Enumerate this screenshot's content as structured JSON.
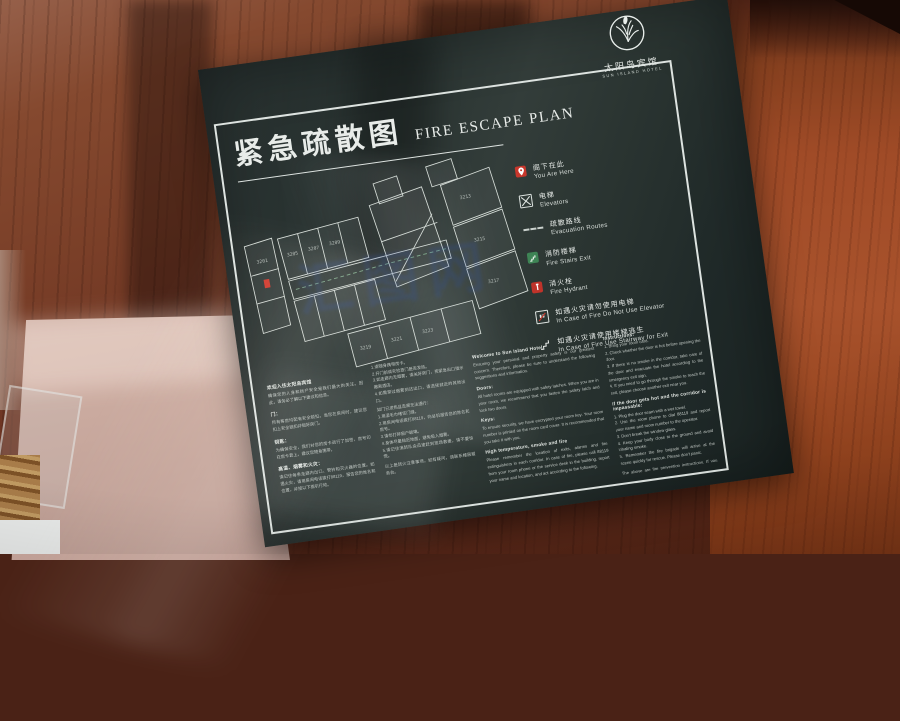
{
  "colors": {
    "sign_background": "#27312f",
    "accent_red": "#c8372c",
    "stairs_green": "#3e8455",
    "wood_brown": "#8a4127",
    "sign_text": "#e8ece9"
  },
  "watermark": {
    "text": "汇图网"
  },
  "sign": {
    "logo": {
      "zh": "太阳岛宾馆",
      "en": "SUN ISLAND HOTEL"
    },
    "title": {
      "zh": "紧急疏散图",
      "en": "FIRE ESCAPE PLAN"
    },
    "legend": [
      {
        "icon": "you-are-here-pin",
        "zh": "阁下在此",
        "en": "You Are Here"
      },
      {
        "icon": "elevator",
        "zh": "电梯",
        "en": "Elevators"
      },
      {
        "icon": "dashed-route",
        "zh": "疏散路线",
        "en": "Evacuation Routes"
      },
      {
        "icon": "green-stairs",
        "zh": "消防楼梯",
        "en": "Fire Stairs Exit"
      },
      {
        "icon": "red-hydrant",
        "zh": "消火栓",
        "en": "Fire Hydrant"
      },
      {
        "icon": "no-elevator",
        "zh": "如遇火灾请勿使用电梯",
        "en": "In Case of Fire Do Not Use Elevator"
      },
      {
        "icon": "stairway-exit",
        "zh": "如遇火灾请使用楼梯逃生",
        "en": "In Case of Fire Use Stairway for Exit"
      }
    ],
    "floor_plan": {
      "rooms": [
        "3201",
        "3205",
        "3207",
        "3209",
        "3213",
        "3215",
        "3217",
        "3219",
        "3221",
        "3223"
      ]
    },
    "info": {
      "zh_welcome": {
        "h0": "欢迎入住太阳岛宾馆",
        "p0": "确保您的人身和财产安全是我们最大的关注。因此，请务必了解以下建议和信息。",
        "h1": "门：",
        "p1": "所有客房均配有安全锁扣。当您在房间时，建议您扣上安全锁扣并锁好房门。",
        "h2": "钥匙：",
        "p2": "为确保安全，我们对您的房卡进行了加密，房号印在房卡套上，建议您随身携带。",
        "h3": "高温、烟雾和火灾：",
        "p3": "请记住每条走廊内出口、警铃和灭火器的位置。如遇火灾，请用房间电话拨打88119，报告您的姓名和位置，并按以下指引行动。"
      },
      "zh_instructions": {
        "p0": "1.请随身携带房卡。\n2.开门前请先检查门是否发热。\n3.如走廊内无烟雾，请关好房门，按紧急出口指示撤离酒店。\n4.如需穿过烟雾到达出口，请选择就近的其他出口。",
        "p1": "如门已发热且走廊无法通行：\n1.用湿毛巾堵住门缝。\n2.用房间电话拨打88119，向总机报告您的姓名和房号。\n3.请勿打碎窗户玻璃。\n4.身体尽量贴近地面，避免吸入烟雾。\n5.请记住消防队会迅速赶到现场救援，请不要惊慌。",
        "p2": "以上是防火注意事项，如有疑问，请联系楼层服务台。"
      },
      "en_welcome": {
        "h0": "Welcome to Sun Island Hotel",
        "p0": "Ensuring your personal and property safety is our greatest concern. Therefore, please be sure to understand the following suggestions and information.",
        "h1": "Doors:",
        "p1": "All hotel rooms are equipped with safety latches. When you are in your room, we recommend that you fasten the safety latch and lock two doors.",
        "h2": "Keys:",
        "p2": "To ensure security, we have encrypted your room key. Your room number is printed on the room card cover. It is recommended that you take it with you.",
        "h3": "High temperature, smoke and fire",
        "p3": "Please remember the location of exits, alarms and fire extinguishers in each corridor. In case of fire, please call 88119 from your room phone or the service desk in the building, report your name and location, and act according to the following."
      },
      "en_instructions": {
        "h0": "Instructions:",
        "p0": "1. Bring your room card.\n2. Check whether the door is hot before opening the door.\n3. If there is no smoke in the corridor, take care of the door and evacuate the hotel according to the emergency exit sign.\n4. If you need to go through the smoke to reach the exit, please choose another exit near you.",
        "h1": "If the door gets hot and the corridor is impassable:",
        "p1": "1. Plug the door seam with a wet towel.\n2. Use the room phone to dial 88119 and report your name and room number to the operator.\n3. Don't break the window glass.\n4. Keep your body close to the ground and avoid inhaling smoke.\n5. Remember the fire brigade will arrive at the scene quickly for rescue. Please don't panic.",
        "p2": "The above are fire prevention instructions. If you have any questions, please contact the building service desk."
      }
    }
  }
}
